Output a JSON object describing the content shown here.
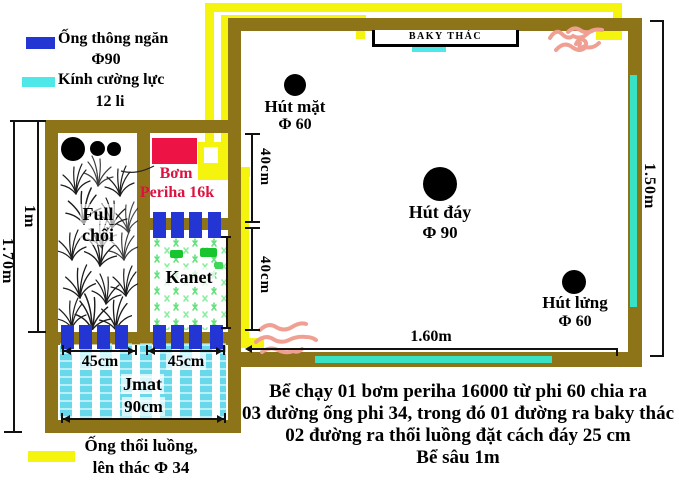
{
  "colors": {
    "wall_brown": "#8d7418",
    "pipe_yellow": "#f5f40e",
    "pipe_blue": "#2336d4",
    "glass_cyan": "#4fe8e8",
    "glass_teal": "#38e2c4",
    "pump_red": "#ee1345",
    "pump_text_red": "#dc1340",
    "splash_pink": "#efa093",
    "kanet_green": "#67e07f",
    "jmat_cyan": "#60d7ea"
  },
  "legend_top": {
    "item1_label": "Ống thông ngăn",
    "item1_size": "Φ90",
    "item2_label": "Kính cường lực",
    "item2_size": "12 li"
  },
  "legend_bottom": {
    "line1": "Ống thổi luồng,",
    "line2": "lên thác Φ 34"
  },
  "filter_box": {
    "pump_label_line1": "Bơm",
    "pump_label_line2": "Periha 16k",
    "media1_line1": "Full",
    "media1_line2": "chổi",
    "media2_label": "Kanet",
    "media3_label": "Jmat"
  },
  "tank": {
    "waterfall_label": "BAKY THÁC",
    "surface_suction_label": "Hút mặt",
    "surface_suction_size": "Φ 60",
    "bottom_suction_label": "Hút đáy",
    "bottom_suction_size": "Φ 90",
    "mid_suction_label": "Hút lửng",
    "mid_suction_size": "Φ 60"
  },
  "dimensions": {
    "filter_total_height": "1.70m",
    "filter_inner_height": "1m",
    "spacing_top": "40cm",
    "spacing_bottom": "40cm",
    "jmat_left_width": "45cm",
    "jmat_right_width": "45cm",
    "jmat_total_width": "90cm",
    "tank_width": "1.60m",
    "tank_height": "1.50m"
  },
  "notes": {
    "line1": "Bể chạy 01 bơm periha 16000 từ phi 60 chia ra",
    "line2": "03 đường ống phi 34, trong đó 01 đường ra baky thác",
    "line3": "02 đường ra thổi luồng đặt cách đáy 25 cm",
    "line4": "Bể sâu 1m"
  }
}
